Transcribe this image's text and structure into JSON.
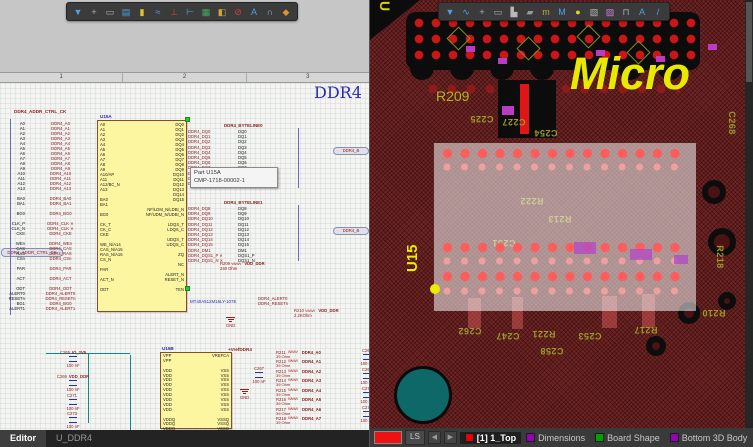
{
  "schematic": {
    "toolbar": [
      {
        "glyph": "▼",
        "name": "filter-icon",
        "style": "color:#4da0e8"
      },
      {
        "glyph": "+",
        "name": "move-icon",
        "style": "color:#a8b8cc"
      },
      {
        "glyph": "▭",
        "name": "rectangle-icon",
        "style": "color:#a8b8cc"
      },
      {
        "glyph": "▤",
        "name": "paste-icon",
        "style": "color:#4da0e8"
      },
      {
        "glyph": "▮",
        "name": "part-icon",
        "style": "color:#e0c233"
      },
      {
        "glyph": "≈",
        "name": "wire-icon",
        "style": "color:#4da0e8"
      },
      {
        "glyph": "⊥",
        "name": "gnd-icon",
        "style": "color:#cc4433"
      },
      {
        "glyph": "⊢",
        "name": "measure-icon",
        "style": "color:#4da0e8"
      },
      {
        "glyph": "▦",
        "name": "image-icon",
        "style": "color:#3fae5e"
      },
      {
        "glyph": "◧",
        "name": "net-label-icon",
        "style": "color:#c8a838"
      },
      {
        "glyph": "⊘",
        "name": "no-erc-icon",
        "style": "color:#cc4433"
      },
      {
        "glyph": "A",
        "name": "text-icon",
        "style": "color:#4da0e8"
      },
      {
        "glyph": "∩",
        "name": "arc-icon",
        "style": "color:#a8b8cc"
      },
      {
        "glyph": "◆",
        "name": "parameter-icon",
        "style": "color:#e09030"
      }
    ],
    "ruler_marks": [
      "1",
      "2",
      "3"
    ],
    "sheet_title": "DDR4",
    "top_label": "DDR4_ADDR_CTRL_CK",
    "left_port": "DDR4_ADDR_CTRL_CK",
    "tooltip": {
      "line1": "Part U15A",
      "line2": "CMP-1718-00002-1"
    },
    "ic_main": {
      "refdes": "U15A",
      "part_number": "MT40A512M16LY-107E",
      "left_pins": [
        "A0",
        "A1",
        "A2",
        "A3",
        "A4",
        "A5",
        "A6",
        "A7",
        "A8",
        "A9",
        "A10/AP",
        "A11",
        "A12/BC_N",
        "A13",
        "",
        "BA0",
        "BA1",
        "",
        "BG0",
        "",
        "CK_T",
        "CK_C",
        "CKE",
        "",
        "WE_N/A14",
        "CAS_N/A15",
        "RAS_N/A16",
        "CS_N",
        "",
        "PAR",
        "",
        "ACT_N",
        "",
        "ODT",
        "",
        "",
        "",
        ""
      ],
      "right_pins": [
        "DQ0",
        "DQ1",
        "DQ2",
        "DQ3",
        "DQ4",
        "DQ5",
        "DQ6",
        "DQ7",
        "DQ8",
        "DQ9",
        "DQ10",
        "DQ11",
        "DQ12",
        "DQ13",
        "DQ14",
        "DQ15",
        "",
        "NF/LDM_N/LDBI_N",
        "NF/UDM_N/UDBI_N",
        "",
        "LDQS_T",
        "LDQS_C",
        "",
        "UDQS_T",
        "UDQS_C",
        "",
        "ZQ",
        "",
        "NC",
        "",
        "ALERT_N",
        "RESET_N",
        "",
        "TEN",
        "",
        "",
        "",
        ""
      ]
    },
    "left_rows": [
      {
        "stub": "A0",
        "net": "DDR4_A0"
      },
      {
        "stub": "A1",
        "net": "DDR4_A1"
      },
      {
        "stub": "A2",
        "net": "DDR4_A2"
      },
      {
        "stub": "A3",
        "net": "DDR4_A3"
      },
      {
        "stub": "A4",
        "net": "DDR4_A4"
      },
      {
        "stub": "A5",
        "net": "DDR4_A5"
      },
      {
        "stub": "A6",
        "net": "DDR4_A6"
      },
      {
        "stub": "A7",
        "net": "DDR4_A7"
      },
      {
        "stub": "A8",
        "net": "DDR4_A8"
      },
      {
        "stub": "A9",
        "net": "DDR4_A9"
      },
      {
        "stub": "A10",
        "net": "DDR4_A10"
      },
      {
        "stub": "A11",
        "net": "DDR4_A11"
      },
      {
        "stub": "A12",
        "net": "DDR4_A12"
      },
      {
        "stub": "A13",
        "net": "DDR4_A13"
      },
      {
        "stub": "",
        "net": ""
      },
      {
        "stub": "BA0",
        "net": "DDR4_BA0"
      },
      {
        "stub": "BA1",
        "net": "DDR4_BA1"
      },
      {
        "stub": "",
        "net": ""
      },
      {
        "stub": "BG0",
        "net": "DDR4_BG0"
      },
      {
        "stub": "",
        "net": ""
      },
      {
        "stub": "CLK_P",
        "net": "DDR4_CLK ✕"
      },
      {
        "stub": "CLK_N",
        "net": "DDR4_CLK ✕"
      },
      {
        "stub": "CKE",
        "net": "DDR4_CKE"
      },
      {
        "stub": "",
        "net": ""
      },
      {
        "stub": "WEn",
        "net": "DDR4_WEn"
      },
      {
        "stub": "CAS",
        "net": "DDR4_CAS"
      },
      {
        "stub": "RAS",
        "net": "DDR4_RAS"
      },
      {
        "stub": "CSn",
        "net": "DDR4_CSn"
      },
      {
        "stub": "",
        "net": ""
      },
      {
        "stub": "PAR",
        "net": "DDR4_PAR"
      },
      {
        "stub": "",
        "net": ""
      },
      {
        "stub": "ACT",
        "net": "DDR4_ACT"
      },
      {
        "stub": "",
        "net": ""
      },
      {
        "stub": "ODT",
        "net": "DDR4_ODT"
      },
      {
        "stub": "ALERT0",
        "net": "DDR4_ALERT0"
      },
      {
        "stub": "RESETn",
        "net": "DDR4_RESETn"
      },
      {
        "stub": "BG1",
        "net": "DDR4_BG0"
      },
      {
        "stub": "ALERT1",
        "net": "DDR4_ALERT1"
      }
    ],
    "groups": [
      {
        "header": "DDR4_BYTELINE0",
        "port": "DDR4_B",
        "rows": [
          {
            "net": "DDR4_DQ0",
            "sig": "DQ0"
          },
          {
            "net": "DDR4_DQ1",
            "sig": "DQ1"
          },
          {
            "net": "DDR4_DQ2",
            "sig": "DQ2"
          },
          {
            "net": "DDR4_DQ3",
            "sig": "DQ3"
          },
          {
            "net": "DDR4_DQ4",
            "sig": "DQ4"
          },
          {
            "net": "DDR4_DQ5",
            "sig": "DQ5"
          },
          {
            "net": "DDR4_DQ6",
            "sig": "DQ6"
          },
          {
            "net": "DDR4_DQ7",
            "sig": "DQ7"
          },
          {
            "net": "DDR4_DM0",
            "sig": "DM0"
          },
          {
            "net": "DDR4_DQS0_P",
            "sig": "DQS0_P"
          },
          {
            "net": "DDR4_DQS0_N",
            "sig": "DQS0_N"
          }
        ]
      },
      {
        "header": "DDR4_BYTELINE1",
        "port": "DDR4_B",
        "rows": [
          {
            "net": "DDR4_DQ8",
            "sig": "DQ8"
          },
          {
            "net": "DDR4_DQ9",
            "sig": "DQ9"
          },
          {
            "net": "DDR4_DQ10",
            "sig": "DQ10"
          },
          {
            "net": "DDR4_DQ11",
            "sig": "DQ11"
          },
          {
            "net": "DDR4_DQ12",
            "sig": "DQ12"
          },
          {
            "net": "DDR4_DQ13",
            "sig": "DQ13"
          },
          {
            "net": "DDR4_DQ14",
            "sig": "DQ14"
          },
          {
            "net": "DDR4_DQ15",
            "sig": "DQ15"
          },
          {
            "net": "DDR4_DM1",
            "sig": "DM1"
          },
          {
            "net": "DDR4_DQS1_P ✕",
            "sig": "DQS1_P"
          },
          {
            "net": "DDR4_DQS1_N ✕",
            "sig": "DQS1_N"
          }
        ]
      }
    ],
    "r209": {
      "ref": "R209",
      "val": "240 Ohm",
      "net": "VDD_DDR"
    },
    "r210": {
      "ref": "R210",
      "val": "2.2KOhm",
      "net": "VDD_DDR"
    },
    "alert_nets": [
      "DDR4_ALERT0",
      "DDR4_RESETn"
    ],
    "gnd_label": "GND",
    "power": {
      "ic": {
        "refdes": "U15B",
        "left_pins": [
          "VPP",
          "VPP",
          "",
          "VDD",
          "VDD",
          "VDD",
          "VDD",
          "VDD",
          "VDD",
          "VDD",
          "VDD",
          "VDD",
          "",
          "VDDQ",
          "VDDQ",
          "VDDQ"
        ],
        "right_pins": [
          "VREFCA",
          "",
          "",
          "VSS",
          "VSS",
          "VSS",
          "VSS",
          "VSS",
          "VSS",
          "VSS",
          "VSS",
          "VSS",
          "",
          "VSSQ",
          "VSSQ",
          "VSSQ"
        ]
      },
      "left_caps": [
        {
          "ref": "C265",
          "net": "IO_2V5",
          "val": "100 nF",
          "style": "left:54px;top:267px"
        },
        {
          "ref": "C269",
          "net": "VDD_DDR",
          "val": "100 nF",
          "style": "left:54px;top:291px"
        },
        {
          "ref": "C271",
          "net": "",
          "val": "100 nF",
          "style": "left:54px;top:310px"
        },
        {
          "ref": "C273",
          "net": "",
          "val": "100 nF",
          "style": "left:54px;top:328px"
        }
      ],
      "vref_label": "+VrefDDR4",
      "vref_cap": {
        "ref": "C267",
        "val": "100 nF",
        "style": "left:240px;top:283px"
      },
      "series_resistors": [
        {
          "ref": "R211",
          "val": "39 Ohm",
          "net": "DDR4_A0",
          "style": "top:267px"
        },
        {
          "ref": "R212",
          "val": "39 Ohm",
          "net": "DDR4_A1",
          "style": "top:276px"
        },
        {
          "ref": "R213",
          "val": "39 Ohm",
          "net": "DDR4_A2",
          "style": "top:286px"
        },
        {
          "ref": "R214",
          "val": "39 Ohm",
          "net": "DDR4_A3",
          "style": "top:295px"
        },
        {
          "ref": "R215",
          "val": "39 Ohm",
          "net": "DDR4_A4",
          "style": "top:305px"
        },
        {
          "ref": "R216",
          "val": "39 Ohm",
          "net": "DDR4_A5",
          "style": "top:314px"
        },
        {
          "ref": "R217",
          "val": "39 Ohm",
          "net": "DDR4_A6",
          "style": "top:324px"
        },
        {
          "ref": "R218",
          "val": "39 Ohm",
          "net": "DDR4_A7",
          "style": "top:333px"
        }
      ],
      "right_caps": [
        {
          "ref": "C264",
          "val": "100 nF",
          "style": "left:348px;top:265px"
        },
        {
          "ref": "C268",
          "val": "100 nF",
          "style": "left:348px;top:284px"
        },
        {
          "ref": "C270",
          "val": "100 nF",
          "style": "left:348px;top:303px"
        },
        {
          "ref": "C272",
          "val": "100 nF",
          "style": "left:348px;top:322px"
        }
      ]
    },
    "editor_tabs": [
      {
        "label": "Editor",
        "active": true,
        "tab": "background:#3e3e3e;color:#fff;font-weight:bold"
      },
      {
        "label": "U_DDR4",
        "active": false,
        "tab": ""
      }
    ]
  },
  "pcb": {
    "toolbar": [
      {
        "glyph": "▼",
        "name": "filter-icon",
        "style": "color:#4da0e8"
      },
      {
        "glyph": "∿",
        "name": "route-icon",
        "style": "color:#4da0e8"
      },
      {
        "glyph": "+",
        "name": "move-icon",
        "style": "color:#a8b8cc"
      },
      {
        "glyph": "▭",
        "name": "rectangle-icon",
        "style": "color:#a8b8cc"
      },
      {
        "glyph": "▙",
        "name": "pad-icon",
        "style": "color:#b8b8b8"
      },
      {
        "glyph": "▰",
        "name": "fill-icon",
        "style": "color:#9898a8"
      },
      {
        "glyph": "m",
        "name": "trace-icon",
        "style": "color:#c8a838"
      },
      {
        "glyph": "M",
        "name": "meander-icon",
        "style": "color:#4da0e8"
      },
      {
        "glyph": "●",
        "name": "via-icon",
        "style": "color:#e8d020"
      },
      {
        "glyph": "▧",
        "name": "polygon-icon",
        "style": "color:#b8b8b8"
      },
      {
        "glyph": "▨",
        "name": "keepout-icon",
        "style": "color:#d080d0"
      },
      {
        "glyph": "⊓",
        "name": "measure-icon",
        "style": "color:#a8b8cc"
      },
      {
        "glyph": "A",
        "name": "text-icon",
        "style": "color:#4da0e8"
      },
      {
        "glyph": "/",
        "name": "line-icon",
        "style": "color:#4da0e8"
      }
    ],
    "silk": {
      "r209": "R209",
      "u15": "U15",
      "logo": "Micro",
      "labels": [
        {
          "text": "C225",
          "style": "left:100px;top:114px;transform:rotate(180deg)"
        },
        {
          "text": "C227",
          "style": "left:132px;top:117px;transform:rotate(180deg)"
        },
        {
          "text": "C254",
          "style": "left:164px;top:128px;transform:rotate(180deg)"
        },
        {
          "text": "R222",
          "style": "left:150px;top:196px;transform:rotate(180deg)"
        },
        {
          "text": "R213",
          "style": "left:178px;top:214px;transform:rotate(180deg)"
        },
        {
          "text": "C251",
          "style": "left:122px;top:238px;transform:rotate(180deg)"
        },
        {
          "text": "R218",
          "style": "left:338px;top:252px;transform:rotate(90deg)"
        },
        {
          "text": "C268",
          "style": "left:350px;top:118px;transform:rotate(90deg)"
        },
        {
          "text": "C262",
          "style": "left:88px;top:326px;transform:rotate(180deg)"
        },
        {
          "text": "C247",
          "style": "left:126px;top:331px;transform:rotate(180deg)"
        },
        {
          "text": "R221",
          "style": "left:162px;top:329px;transform:rotate(180deg)"
        },
        {
          "text": "C258",
          "style": "left:170px;top:346px;transform:rotate(180deg)"
        },
        {
          "text": "C253",
          "style": "left:208px;top:331px;transform:rotate(180deg)"
        },
        {
          "text": "R217",
          "style": "left:264px;top:325px;transform:rotate(180deg)"
        },
        {
          "text": "R210",
          "style": "left:332px;top:308px;transform:rotate(180deg)"
        }
      ]
    },
    "status_bar": {
      "ls": "LS",
      "prev": "◀",
      "next": "▶",
      "layers": [
        {
          "label": "[1] 1_Top",
          "active": true,
          "swatch": "background:#e80000",
          "tab": "background:#1f1f1f;color:#fff;font-weight:bold"
        },
        {
          "label": "Dimensions",
          "active": false,
          "swatch": "background:#9600b4",
          "tab": ""
        },
        {
          "label": "Board Shape",
          "active": false,
          "swatch": "background:#00a000",
          "tab": ""
        },
        {
          "label": "Bottom 3D Body",
          "active": false,
          "swatch": "background:#9600b4",
          "tab": ""
        },
        {
          "label": "Notes",
          "active": false,
          "swatch": "background:#101010",
          "tab": ""
        },
        {
          "label": "Top Ov",
          "active": false,
          "swatch": "background:#f0f000",
          "tab": ""
        }
      ]
    },
    "colors": {
      "board": "#702525",
      "pad": "#ff5c5c",
      "bright_trace": "#cc1616",
      "silk": "#9a9a28",
      "logo_yellow": "#e9e900",
      "highlight_overlay": "rgba(246,246,246,0.55)"
    }
  }
}
